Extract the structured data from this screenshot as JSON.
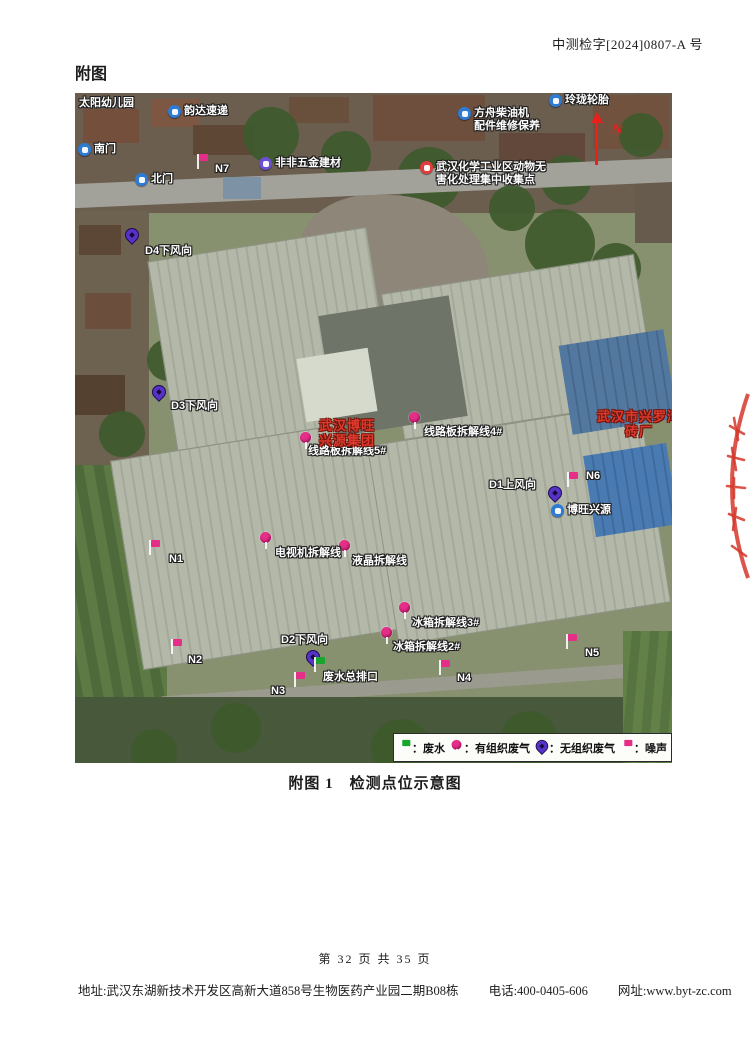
{
  "header": {
    "doc_number": "中测检字[2024]0807-A 号"
  },
  "section": {
    "title": "附图"
  },
  "caption": {
    "text": "附图 1　检测点位示意图"
  },
  "footer": {
    "page_info": "第 32 页 共 35 页",
    "address": "地址:武汉东湖新技术开发区高新大道858号生物医药产业园二期B08栋",
    "phone": "电话:400-0405-606",
    "website": "网址:www.byt-zc.com"
  },
  "map": {
    "north_label": "N",
    "pois": [
      {
        "icon": "",
        "lines": [
          "太阳幼儿园"
        ],
        "pos": [
          4,
          4
        ]
      },
      {
        "icon": "blue",
        "lines": [
          "韵达速递"
        ],
        "pos": [
          93,
          12
        ]
      },
      {
        "icon": "blue",
        "lines": [
          "南门"
        ],
        "pos": [
          3,
          50
        ]
      },
      {
        "icon": "blue",
        "lines": [
          "北门"
        ],
        "pos": [
          60,
          80
        ]
      },
      {
        "icon": "purple",
        "lines": [
          "非非五金建材"
        ],
        "pos": [
          184,
          64
        ]
      },
      {
        "icon": "blue",
        "lines": [
          "方舟柴油机",
          "配件维修保养"
        ],
        "pos": [
          383,
          14
        ]
      },
      {
        "icon": "blue",
        "lines": [
          "玲珑轮胎"
        ],
        "pos": [
          474,
          1
        ]
      },
      {
        "icon": "red",
        "lines": [
          "武汉化学工业区动物无",
          "害化处理集中收集点"
        ],
        "pos": [
          345,
          68
        ]
      },
      {
        "icon": "blue",
        "lines": [
          "博旺兴源"
        ],
        "pos": [
          476,
          411
        ]
      }
    ],
    "noise_points": [
      {
        "label": "N7",
        "flag": [
          120,
          60
        ],
        "text": [
          140,
          70
        ]
      },
      {
        "label": "N6",
        "flag": [
          490,
          378
        ],
        "text": [
          511,
          377
        ]
      },
      {
        "label": "N1",
        "flag": [
          72,
          446
        ],
        "text": [
          94,
          460
        ]
      },
      {
        "label": "N2",
        "flag": [
          94,
          545
        ],
        "text": [
          113,
          561
        ]
      },
      {
        "label": "N3",
        "flag": [
          217,
          578
        ],
        "text": [
          196,
          592
        ]
      },
      {
        "label": "N4",
        "flag": [
          362,
          566
        ],
        "text": [
          382,
          579
        ]
      },
      {
        "label": "N5",
        "flag": [
          489,
          540
        ],
        "text": [
          510,
          554
        ]
      }
    ],
    "organized_gas_points": [
      {
        "label": "线路板拆解线4#",
        "pin": [
          333,
          318
        ],
        "text": [
          349,
          333
        ]
      },
      {
        "label": "线路板拆解线5#",
        "pin": [
          224,
          338
        ],
        "text": [
          233,
          352
        ]
      },
      {
        "label": "电视机拆解线",
        "pin": [
          184,
          438
        ],
        "text": [
          200,
          454
        ]
      },
      {
        "label": "液晶拆解线",
        "pin": [
          263,
          446
        ],
        "text": [
          277,
          462
        ]
      },
      {
        "label": "冰箱拆解线3#",
        "pin": [
          323,
          508
        ],
        "text": [
          337,
          524
        ]
      },
      {
        "label": "冰箱拆解线2#",
        "pin": [
          305,
          533
        ],
        "text": [
          318,
          548
        ]
      }
    ],
    "unorganized_gas_points": [
      {
        "label": "D4下风向",
        "pin": [
          50,
          134
        ],
        "text": [
          70,
          152
        ]
      },
      {
        "label": "D3下风向",
        "pin": [
          77,
          291
        ],
        "text": [
          96,
          307
        ]
      },
      {
        "label": "D1上风向",
        "pin": [
          473,
          392
        ],
        "text": [
          414,
          386
        ]
      },
      {
        "label": "D2下风向",
        "pin": [
          231,
          556
        ],
        "text": [
          206,
          541
        ]
      }
    ],
    "wastewater_points": [
      {
        "label": "废水总排口",
        "flag": [
          237,
          563
        ],
        "text": [
          248,
          578
        ]
      }
    ],
    "red_sites": [
      {
        "lines": [
          "武汉博旺",
          "兴源集团"
        ],
        "pos": [
          244,
          325
        ]
      },
      {
        "lines": [
          "武汉市兴罗湾",
          "砖厂"
        ],
        "pos": [
          522,
          316
        ]
      }
    ],
    "legend": {
      "items": [
        {
          "icon": "green-flag",
          "label": "：废水"
        },
        {
          "icon": "pink-pin",
          "label": "：有组织废气"
        },
        {
          "icon": "purple-pin",
          "label": "：无组织废气"
        },
        {
          "icon": "pink-flag",
          "label": "：噪声"
        }
      ]
    }
  }
}
